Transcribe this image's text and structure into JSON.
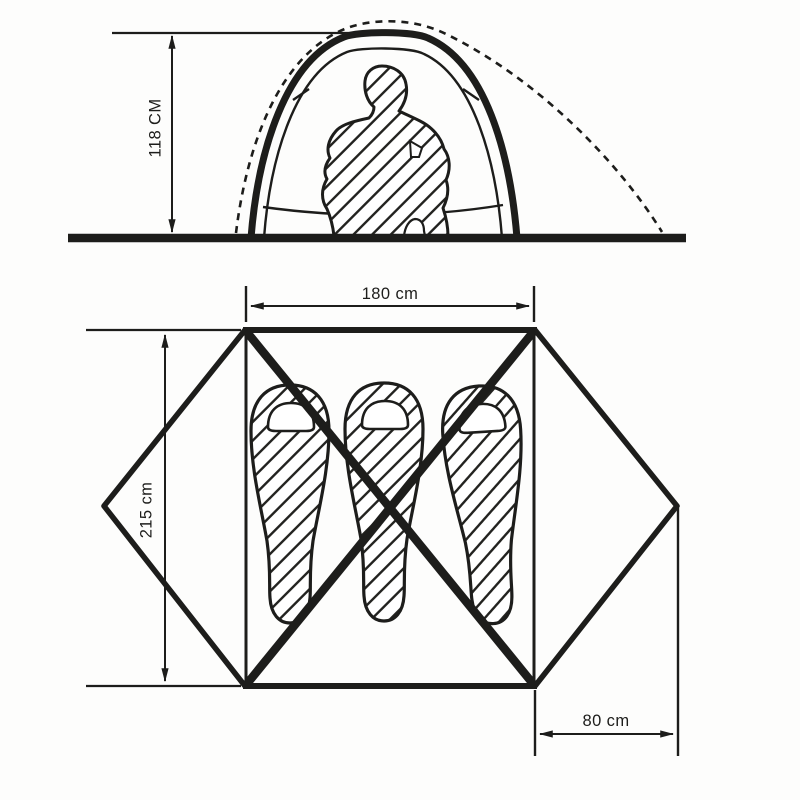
{
  "diagram": {
    "side_view": {
      "height_label": "118 CM",
      "height_value_cm": 118
    },
    "floor_plan": {
      "width_label": "180 cm",
      "width_value_cm": 180,
      "depth_label": "215 cm",
      "depth_value_cm": 215,
      "vestibule_label": "80 cm",
      "vestibule_value_cm": 80,
      "sleeping_bag_count": 3
    },
    "colors": {
      "ink": "#1d1d1b",
      "paper": "#fdfdfc"
    }
  }
}
